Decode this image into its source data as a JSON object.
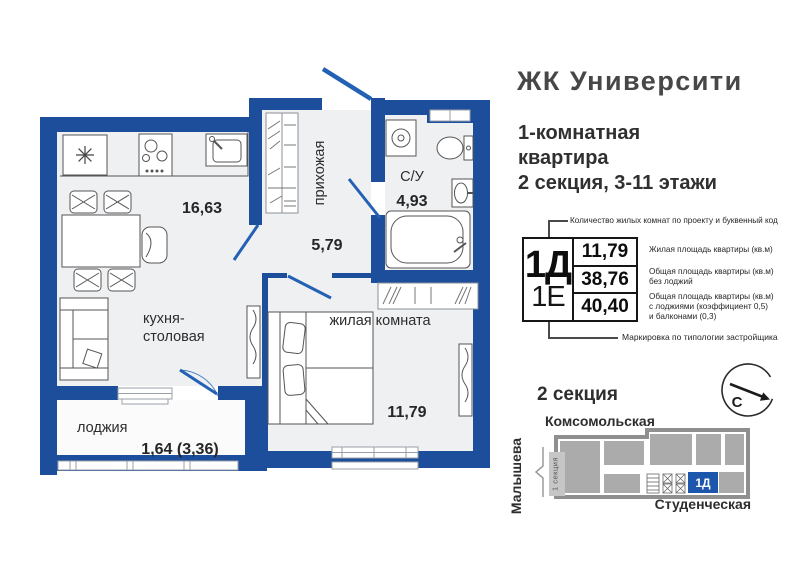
{
  "header": {
    "title": "ЖК Университи",
    "subtitle_line1": "1-комнатная",
    "subtitle_line2": "квартира",
    "subtitle_line3": "2 секция, 3-11 этажи"
  },
  "floor_plan": {
    "kitchen": {
      "name_line1": "кухня-",
      "name_line2": "столовая",
      "area": "16,63"
    },
    "hallway": {
      "name": "прихожая",
      "area": "5,79"
    },
    "bathroom": {
      "name": "С/У",
      "area": "4,93"
    },
    "living": {
      "name": "жилая комната",
      "area": "11,79"
    },
    "loggia": {
      "name": "лоджия",
      "area": "1,64 (3,36)"
    }
  },
  "spec": {
    "top_note": "Количество жилых комнат по проекту и буквенный код",
    "code_primary": "1Д",
    "code_secondary": "1Е",
    "area_living": "11,79",
    "area_no_loggia": "38,76",
    "area_total": "40,40",
    "note_living": "Жилая площадь квартиры (кв.м)",
    "note_no_loggia_line1": "Общая площадь квартиры (кв.м)",
    "note_no_loggia_line2": "без лоджий",
    "note_total_line1": "Общая площадь квартиры (кв.м)",
    "note_total_line2": "с лоджиями (коэффициент 0,5)",
    "note_total_line3": "и балконами (0,3)",
    "bottom_note": "Маркировка по типологии застройщика"
  },
  "section_map": {
    "heading": "2 секция",
    "compass_letter": "С",
    "street_top": "Комсомольская",
    "street_left": "Малышева",
    "street_bottom": "Студенческая",
    "section_tag": "1 секция",
    "unit_label": "1Д"
  },
  "colors": {
    "wall_blue": "#1d4e9b",
    "door_blue": "#2361b5",
    "floor_gray": "#eff0f2",
    "unit_blue": "#1c56ad",
    "building_gray": "#ababab"
  }
}
